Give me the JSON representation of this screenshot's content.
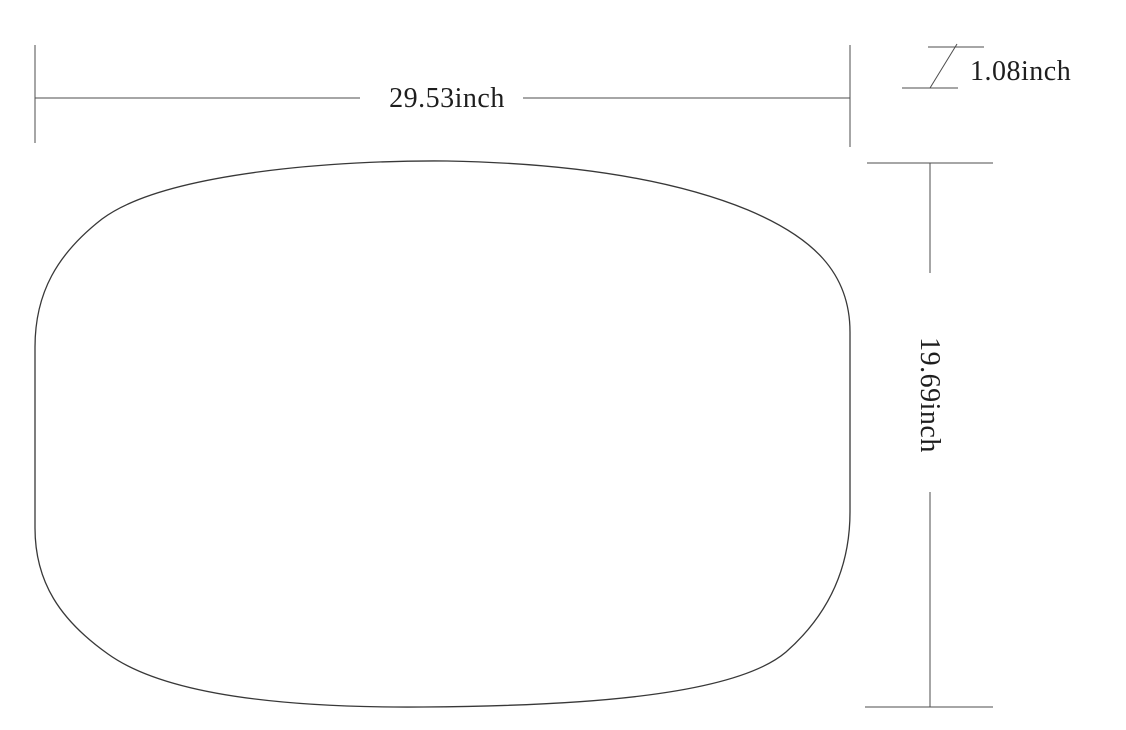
{
  "drawing": {
    "width_label": "29.53inch",
    "height_label": "19.69inch",
    "thickness_label": "1.08inch"
  },
  "colors": {
    "background": "#ffffff",
    "dimension_line": "#4d4d4d",
    "outline": "#383838",
    "text": "#1e1e1e"
  }
}
